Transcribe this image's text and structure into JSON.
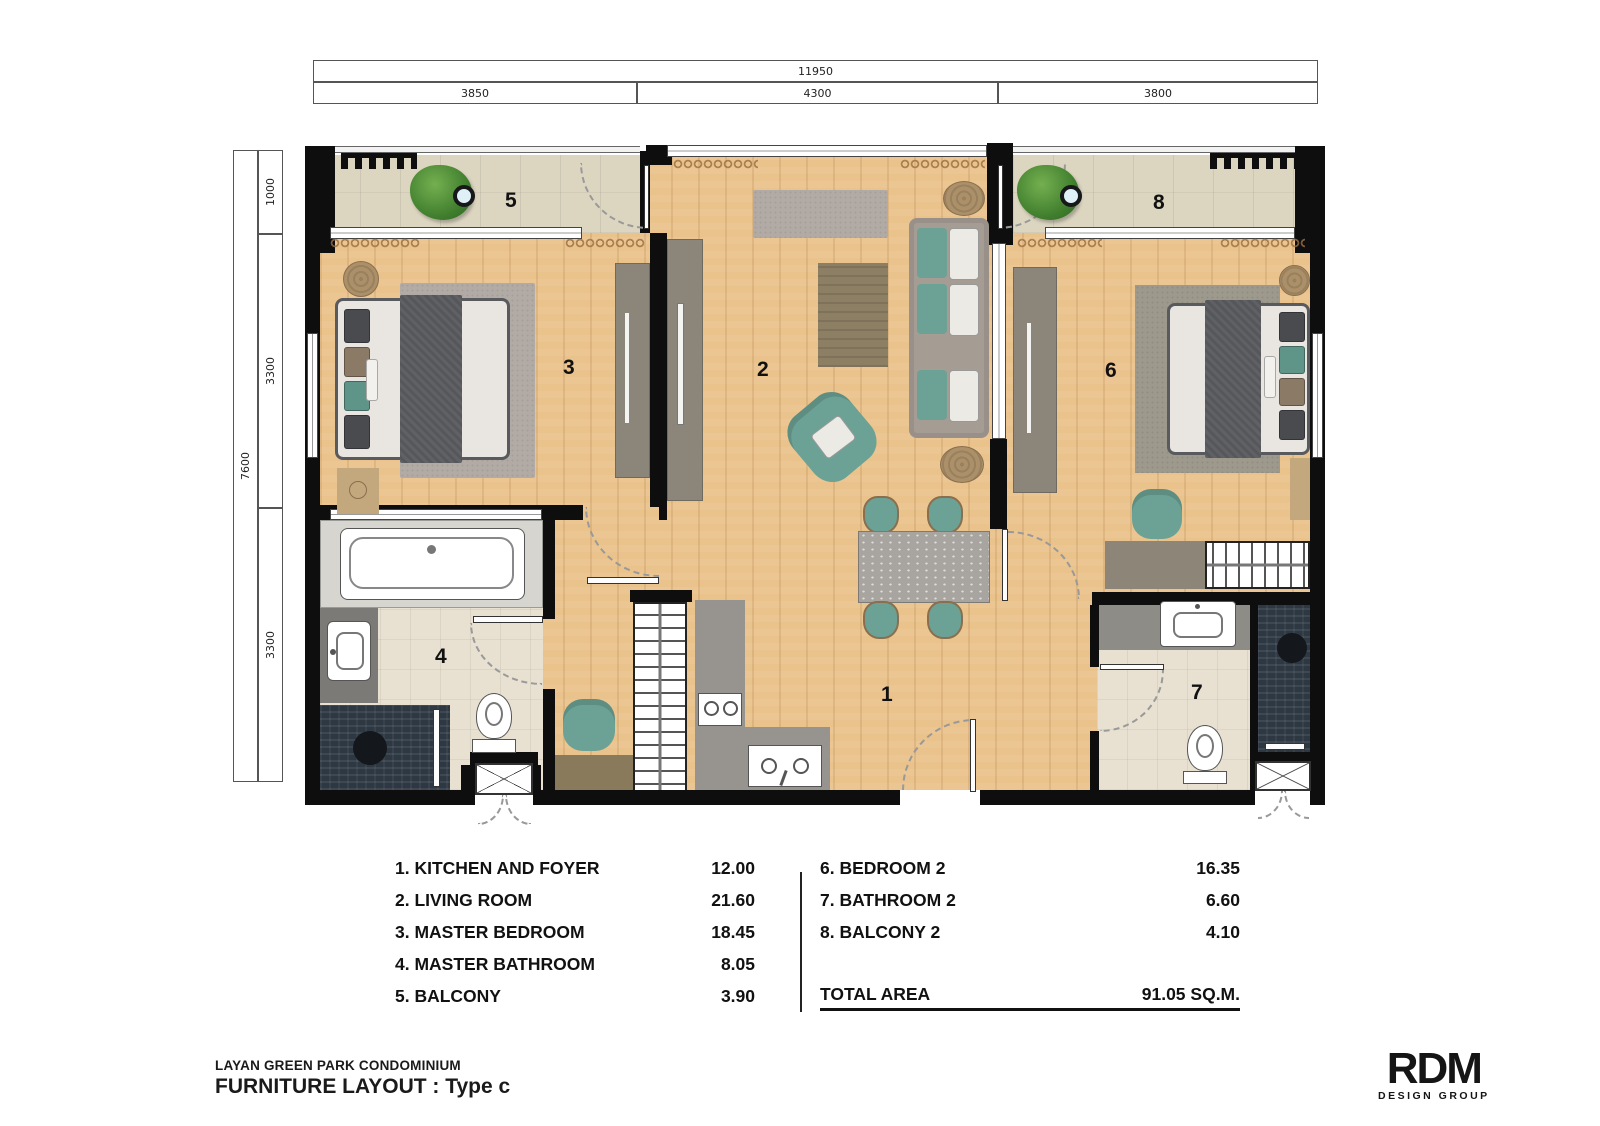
{
  "title_block": {
    "project": "LAYAN GREEN PARK CONDOMINIUM",
    "layout": "FURNITURE LAYOUT : Type c"
  },
  "logo": {
    "name": "RDM",
    "tagline": "DESIGN GROUP"
  },
  "dimensions": {
    "top": {
      "total": "11950",
      "segments": [
        "3850",
        "4300",
        "3800"
      ]
    },
    "side": {
      "total": "7600",
      "segments": [
        "1000",
        "3300",
        "3300"
      ]
    }
  },
  "rooms": [
    {
      "plan_label": "1",
      "legend_label": "1. KITCHEN AND FOYER",
      "area": "12.00"
    },
    {
      "plan_label": "2",
      "legend_label": "2. LIVING ROOM",
      "area": "21.60"
    },
    {
      "plan_label": "3",
      "legend_label": "3. MASTER BEDROOM",
      "area": "18.45"
    },
    {
      "plan_label": "4",
      "legend_label": "4. MASTER BATHROOM",
      "area": "8.05"
    },
    {
      "plan_label": "5",
      "legend_label": "5. BALCONY",
      "area": "3.90"
    },
    {
      "plan_label": "6",
      "legend_label": "6. BEDROOM 2",
      "area": "16.35"
    },
    {
      "plan_label": "7",
      "legend_label": "7. BATHROOM 2",
      "area": "6.60"
    },
    {
      "plan_label": "8",
      "legend_label": "8. BALCONY 2",
      "area": "4.10"
    }
  ],
  "legend": {
    "total_label": "TOTAL AREA",
    "total_value": "91.05 SQ.M."
  },
  "colors": {
    "wall": "#0e0e0e",
    "wood_floor": "#eac28b",
    "balcony_tile": "#dcd6c1",
    "bath_tile": "#e8e1d1",
    "shower_tile": "#2e3843",
    "teal_accent": "#6ba295",
    "counter_gray": "#97948f",
    "cabinet_gray": "#8b857a"
  }
}
